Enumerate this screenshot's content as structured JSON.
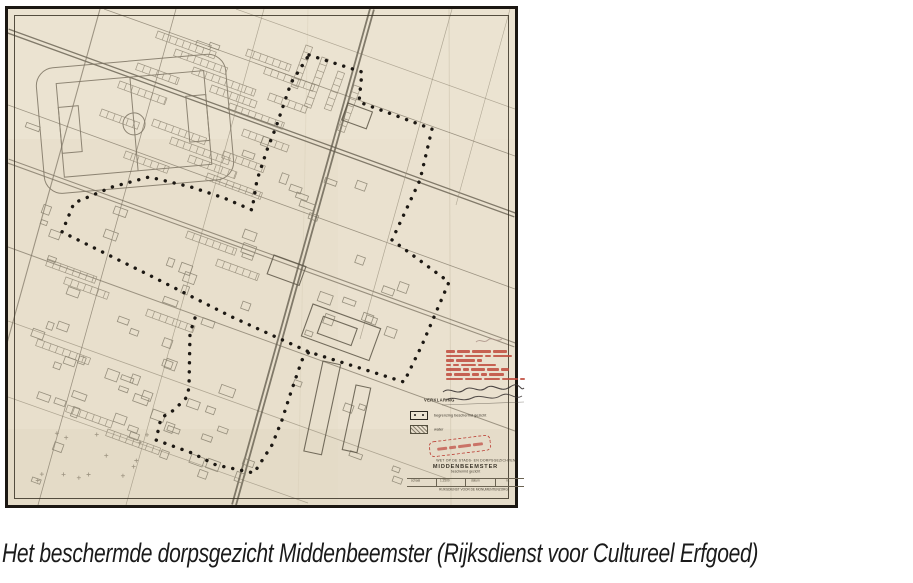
{
  "figure": {
    "caption": "Het beschermde dorpsgezicht Middenbeemster (Rijksdienst voor Cultureel Erfgoed)"
  },
  "map": {
    "legend": {
      "heading": "VERKLARING",
      "items": [
        {
          "symbol": "dotted-boundary",
          "label": "begrenzing beschermd gezicht"
        },
        {
          "symbol": "hatched-area",
          "label": "water"
        }
      ]
    },
    "stamps": {
      "approval_stamp": {
        "color": "#bf4a3c",
        "lines": 7,
        "legible": false
      },
      "oval_stamp": {
        "color": "#c05045",
        "legible": false
      }
    },
    "title_block": {
      "line1": "WET OP DE STADS- EN DORPSGEZICHTEN",
      "name": "MIDDENBEEMSTER",
      "subtitle": "beschermd gezicht",
      "table": [
        "schaal",
        "1:2500",
        "datum",
        "nr."
      ],
      "footer": "RIJKSDIENST VOOR DE MONUMENTENZORG"
    },
    "colors": {
      "paper": "#e8dfcc",
      "linework": "#7d7463",
      "boundary": "#1c1813",
      "stamp_red": "#bf4a3c"
    }
  }
}
